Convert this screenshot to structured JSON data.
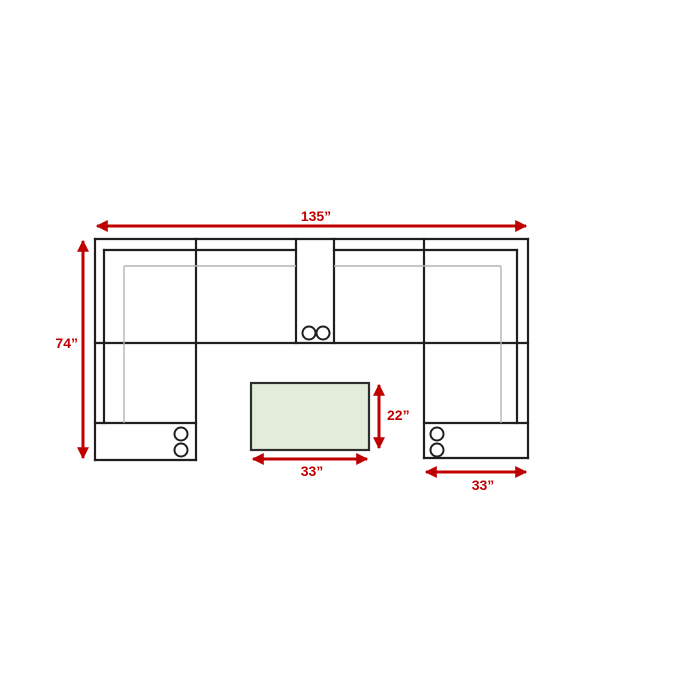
{
  "diagram": {
    "type": "sectional-sofa-floorplan",
    "unit": "inches",
    "colors": {
      "arrow_red": "#c00000",
      "outline": "#1f1f1f",
      "light_line": "#b3b3b3",
      "ottoman_fill": "#e2ecd8"
    },
    "labels": {
      "overall_width": "135”",
      "overall_depth": "74”",
      "ottoman_depth": "22”",
      "ottoman_width": "33”",
      "chaise_width": "33”"
    }
  }
}
